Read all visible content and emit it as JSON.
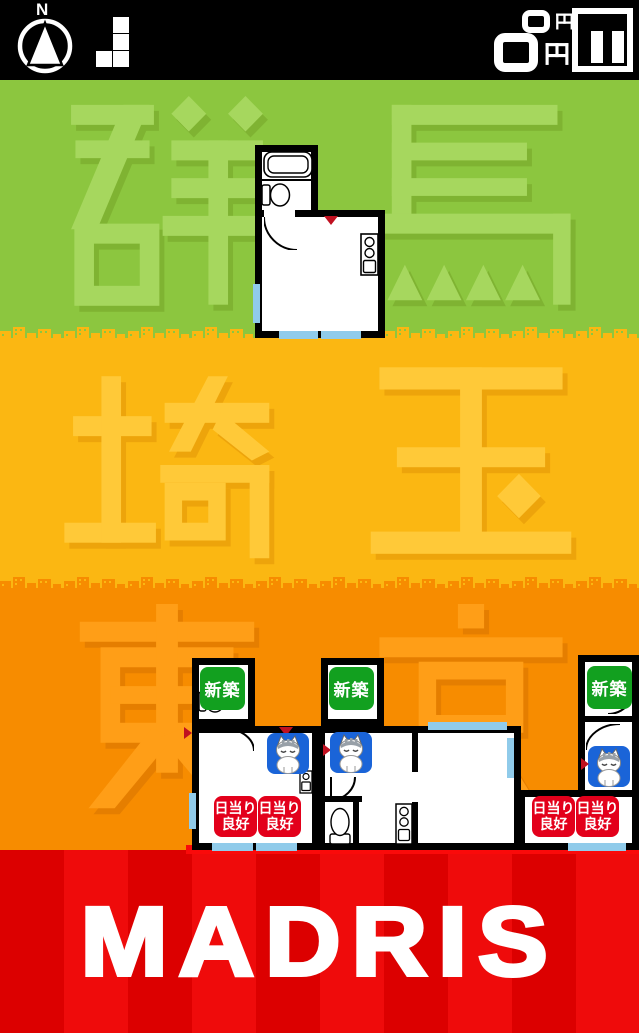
{
  "hud": {
    "compass_label": "N",
    "next_piece_icon": "tetromino-j",
    "score_secondary": "0円",
    "score_primary": "0円",
    "currency_unit": "円"
  },
  "prefectures": [
    {
      "name": "群馬",
      "chars": [
        "群",
        "馬"
      ]
    },
    {
      "name": "埼玉",
      "chars": [
        "埼",
        "玉"
      ]
    },
    {
      "name": "東京",
      "chars": [
        "東",
        "京"
      ]
    }
  ],
  "badges": {
    "new_construction": "新築",
    "good_sunlight_line1": "日当り",
    "good_sunlight_line2": "良好"
  },
  "logo": "MADRIS",
  "colors": {
    "band_gunma_bg": "#8CC63F",
    "band_gunma_text": "#A6D75E",
    "band_saitama_bg": "#FBB712",
    "band_saitama_text": "#FFC938",
    "band_tokyo_bg": "#F78C00",
    "band_tokyo_text": "#FF9E17",
    "logo_stripe_dark": "#DC0000",
    "logo_stripe_bright": "#EF0B0B",
    "ground_line": "#FA0A0A",
    "badge_new_bg": "#12A01F",
    "badge_sunlight_bg": "#E3001B",
    "badge_cat_bg": "#1A64D8",
    "window_blue": "#90CBEA",
    "entrance_marker_red": "#C01020",
    "hud_bg": "#000000",
    "hud_fg": "#FFFFFF"
  }
}
